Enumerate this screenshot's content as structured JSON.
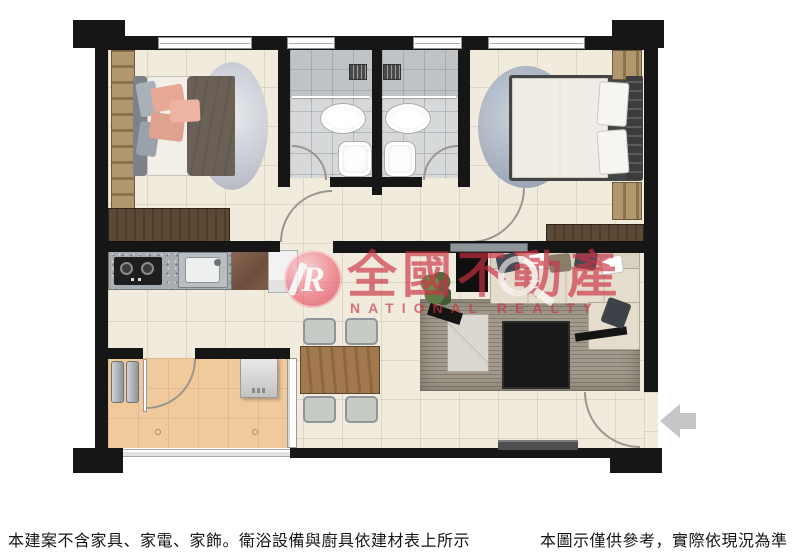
{
  "watermark": {
    "logo_letter": "R",
    "brand_name": "全國不動產",
    "brand_name_en": "NATIONAL REALTY",
    "brand_color": "#cc3344"
  },
  "footer": {
    "left_note": "本建案不含家具、家電、家飾。衛浴設備與廚具依建材表上所示",
    "right_note": "本圖示僅供參考，實際依現況為準"
  },
  "icons": {
    "entrance_arrow": "left-arrow",
    "watermark_magnifier": "magnifying-glass"
  },
  "colors": {
    "wall": "#161616",
    "interior_floor": "#f1ebdd",
    "bathroom_floor": "#d6d8da",
    "balcony_floor": "#f0c99d",
    "watermark_red": "#cc3344",
    "entrance_arrow_gray": "#c6c6c6"
  }
}
